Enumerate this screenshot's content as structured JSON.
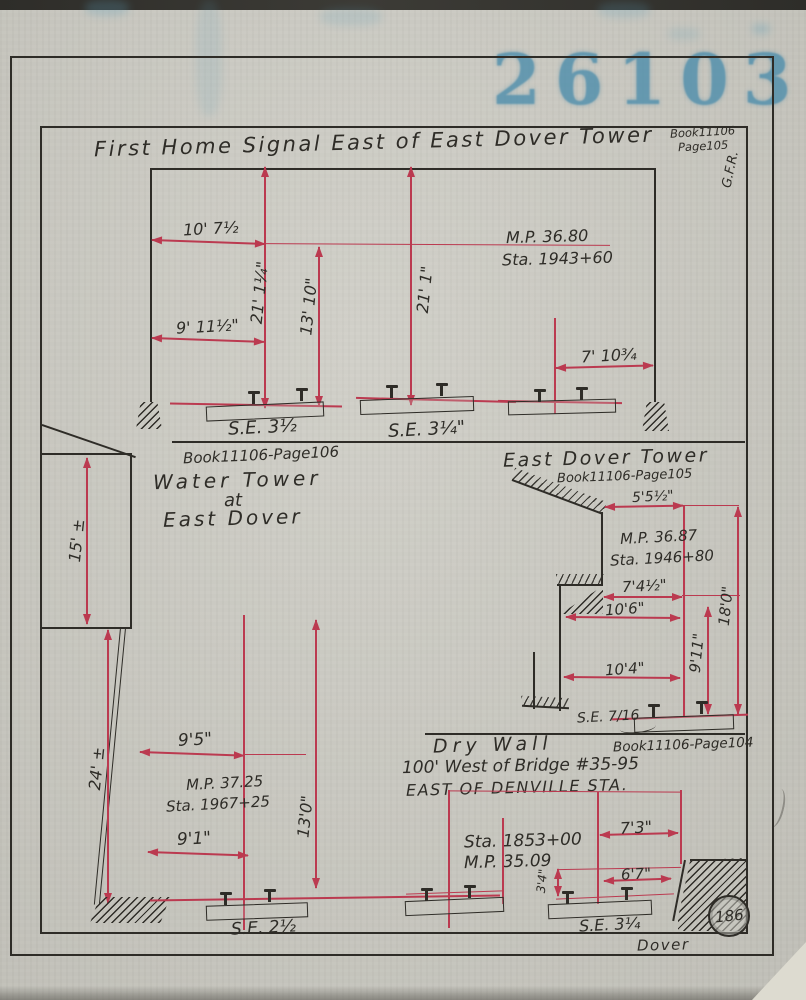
{
  "colors": {
    "paper": "#cbcac2",
    "ink": "#2e2c27",
    "dimension_red": "#bb3a50",
    "stamp_blue": "#4a8cab"
  },
  "stamp": {
    "text": "26103"
  },
  "header": {
    "title": "First Home Signal East of East Dover Tower",
    "book_line1": "Book11106",
    "book_line2": "Page105",
    "initials": "G.F.R."
  },
  "signal_drawing": {
    "dim_10_7": "10' 7½",
    "dim_21_1_4": "21' 1¼\"",
    "dim_13_10": "13' 10\"",
    "dim_9_11_5": "9' 11½\"",
    "dim_21_1": "21' 1\"",
    "milepost": "M.P. 36.80",
    "station": "Sta. 1943+60",
    "dim_7_10": "7' 10¾",
    "se_1": "S.E. 3½",
    "se_2": "S.E. 3¼\"",
    "book_ref": "Book11106-Page106"
  },
  "water_tower": {
    "line1": "Water Tower",
    "line2": "at",
    "line3": "East Dover",
    "dim_15": "15' ±",
    "dim_24": "24' ±",
    "dim_9_5": "9'5\"",
    "milepost": "M.P. 37.25",
    "station": "Sta. 1967+25",
    "dim_13_0": "13'0\"",
    "dim_9_1": "9'1\"",
    "se": "S.E. 2½"
  },
  "tower_drawing": {
    "title": "East Dover Tower",
    "book_ref": "Book11106-Page105",
    "dim_5_5": "5'5½\"",
    "milepost": "M.P. 36.87",
    "station": "Sta. 1946+80",
    "dim_7_4": "7'4½\"",
    "dim_10_6": "10'6\"",
    "dim_9_11": "9'11\"",
    "dim_18_0": "18'0\"",
    "dim_10_4": "10'4\"",
    "se": "S.E. 7/16",
    "book_ref_2": "Book11106-Page104"
  },
  "dry_wall": {
    "title": "Dry Wall",
    "location_line": "100' West of Bridge #35-95",
    "area_line": "EAST OF DENVILLE STA.",
    "station": "Sta. 1853+00",
    "milepost": "M.P. 35.09",
    "dim_7_3": "7'3\"",
    "dim_3_4": "3'4\"",
    "dim_6_7": "6'7\"",
    "se": "S.E. 3¼"
  },
  "footer": {
    "location": "Dover",
    "page_badge": "186"
  }
}
